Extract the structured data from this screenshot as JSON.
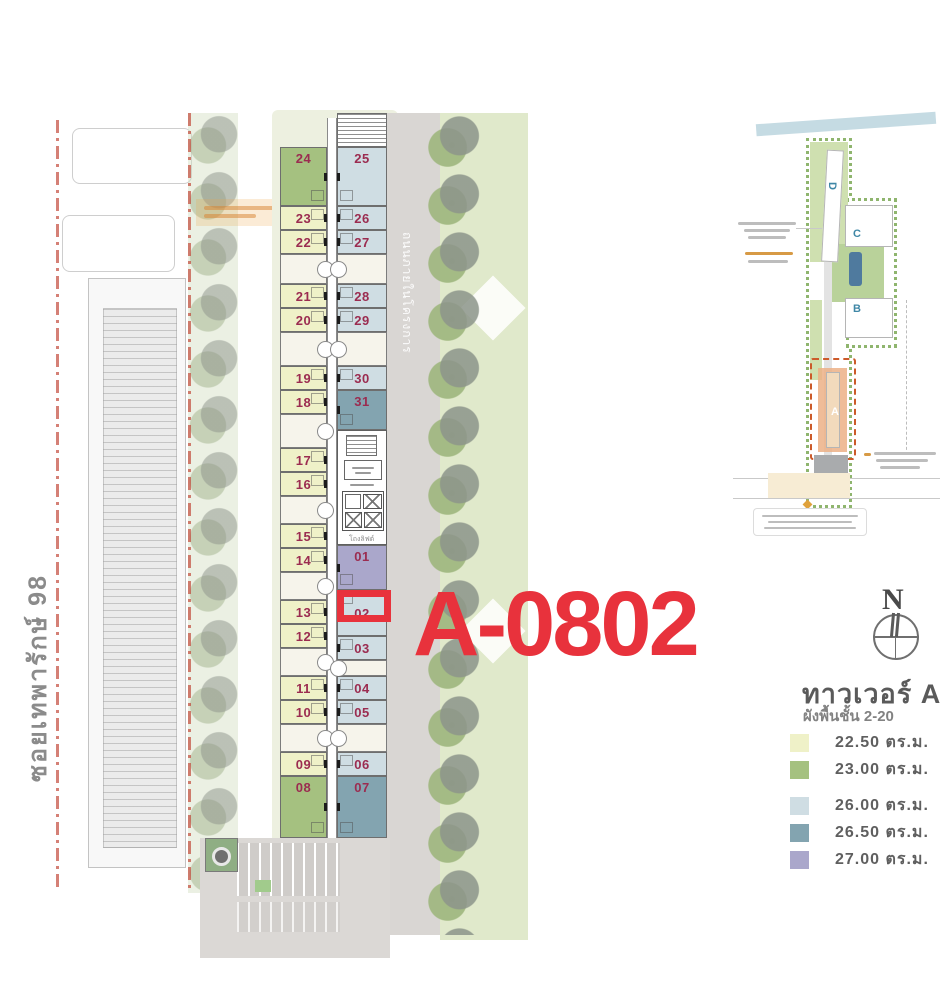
{
  "highlight": {
    "unit_code": "A-0802",
    "color": "#e8323c"
  },
  "labels": {
    "street": "ซอยเทพารักษ์ 98",
    "internal_road": "ถนนภายในโครงการ",
    "lift_hall": "โถงลิฟต์"
  },
  "compass": {
    "north": "N"
  },
  "legend": {
    "title": "ทาวเวอร์ A",
    "subtitle": "ผังพื้นชั้น 2-20",
    "items": [
      {
        "label": "22.50 ตร.ม.",
        "color": "#eff1c8"
      },
      {
        "label": "23.00 ตร.ม.",
        "color": "#a5c180"
      },
      {
        "label": "26.00 ตร.ม.",
        "color": "#cfdde3"
      },
      {
        "label": "26.50 ตร.ม.",
        "color": "#83a4b0"
      },
      {
        "label": "27.00 ตร.ม.",
        "color": "#aaa7cb"
      }
    ]
  },
  "sitemap": {
    "towers": [
      {
        "label": "D"
      },
      {
        "label": "C"
      },
      {
        "label": "B"
      },
      {
        "label": "A"
      }
    ]
  },
  "plan": {
    "units": [
      {
        "no": "24",
        "area_sqm": "23.00"
      },
      {
        "no": "23",
        "area_sqm": "22.50"
      },
      {
        "no": "22",
        "area_sqm": "22.50"
      },
      {
        "no": "21",
        "area_sqm": "22.50"
      },
      {
        "no": "20",
        "area_sqm": "22.50"
      },
      {
        "no": "19",
        "area_sqm": "22.50"
      },
      {
        "no": "18",
        "area_sqm": "22.50"
      },
      {
        "no": "17",
        "area_sqm": "22.50"
      },
      {
        "no": "16",
        "area_sqm": "22.50"
      },
      {
        "no": "15",
        "area_sqm": "22.50"
      },
      {
        "no": "14",
        "area_sqm": "22.50"
      },
      {
        "no": "13",
        "area_sqm": "22.50"
      },
      {
        "no": "12",
        "area_sqm": "22.50"
      },
      {
        "no": "11",
        "area_sqm": "22.50"
      },
      {
        "no": "10",
        "area_sqm": "22.50"
      },
      {
        "no": "09",
        "area_sqm": "22.50"
      },
      {
        "no": "08",
        "area_sqm": "23.00"
      },
      {
        "no": "25",
        "area_sqm": "26.00"
      },
      {
        "no": "26",
        "area_sqm": "26.00"
      },
      {
        "no": "27",
        "area_sqm": "26.00"
      },
      {
        "no": "28",
        "area_sqm": "26.00"
      },
      {
        "no": "29",
        "area_sqm": "26.00"
      },
      {
        "no": "30",
        "area_sqm": "26.00"
      },
      {
        "no": "31",
        "area_sqm": "26.50"
      },
      {
        "no": "01",
        "area_sqm": "27.00"
      },
      {
        "no": "02",
        "area_sqm": "26.00"
      },
      {
        "no": "03",
        "area_sqm": "26.00"
      },
      {
        "no": "04",
        "area_sqm": "26.00"
      },
      {
        "no": "05",
        "area_sqm": "26.00"
      },
      {
        "no": "06",
        "area_sqm": "26.00"
      },
      {
        "no": "07",
        "area_sqm": "26.50"
      }
    ]
  }
}
